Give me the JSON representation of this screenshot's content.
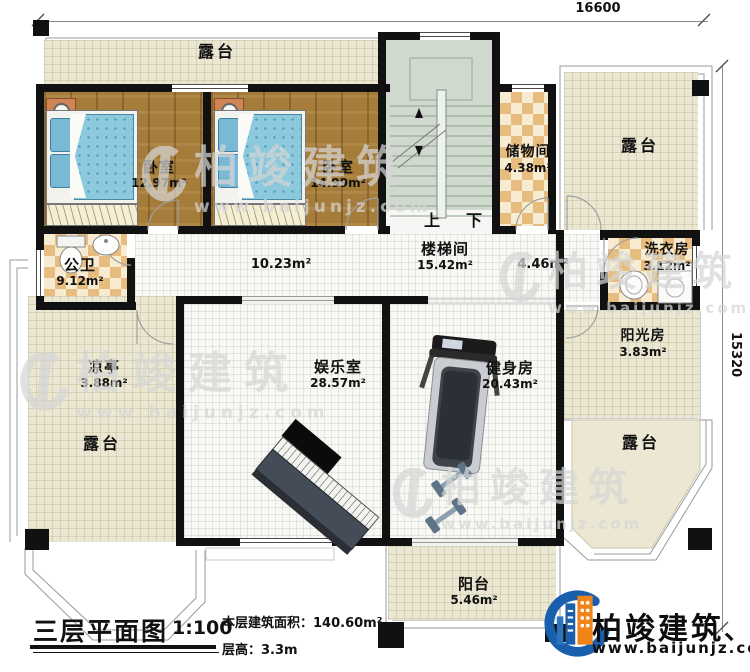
{
  "plan": {
    "dim_width": "16600",
    "dim_height": "15320"
  },
  "rooms": {
    "terrace_top": {
      "name": "露台"
    },
    "terrace_right": {
      "name": "露台"
    },
    "terrace_left": {
      "name": "露台"
    },
    "terrace_bottom_right": {
      "name": "露台"
    },
    "bedroom_left": {
      "name": "卧室",
      "area": "12.97m²"
    },
    "bedroom_right": {
      "name": "卧室",
      "area": "14.99m²"
    },
    "storage": {
      "name": "储物间",
      "area": "4.38m²"
    },
    "stairwell": {
      "name": "楼梯间",
      "area": "15.42m²",
      "up": "上",
      "down": "下"
    },
    "corridor": {
      "area": "10.23m²"
    },
    "hall": {
      "area": "4.46m²"
    },
    "bathroom": {
      "name": "公卫",
      "area": "9.12m²"
    },
    "laundry": {
      "name": "洗衣房",
      "area": "3.12m²"
    },
    "pavilion": {
      "name": "凉亭",
      "area": "3.88m²"
    },
    "entertainment": {
      "name": "娱乐室",
      "area": "28.57m²"
    },
    "gym": {
      "name": "健身房",
      "area": "20.43m²"
    },
    "sunroom": {
      "name": "阳光房",
      "area": "3.83m²"
    },
    "balcony": {
      "name": "阳台",
      "area": "5.46m²"
    }
  },
  "title_block": {
    "title": "三层平面图",
    "scale": "1:100",
    "area_line": "本层建筑面积：140.60m²",
    "height_line": "层高：3.3m"
  },
  "logo": {
    "company": "柏竣建筑",
    "mark": "、",
    "website": "www.baijunjz.com"
  },
  "watermark": {
    "brand": "柏竣建筑",
    "site": "www.baijunjz.com"
  },
  "colors": {
    "wall": "#111111",
    "wood": "#a67c3a",
    "cream": "#ebe7d2",
    "stair": "#cfd9cd",
    "checker": "#e6bd7e",
    "brand_blue": "#1a5fae",
    "brand_orange": "#f08419"
  }
}
